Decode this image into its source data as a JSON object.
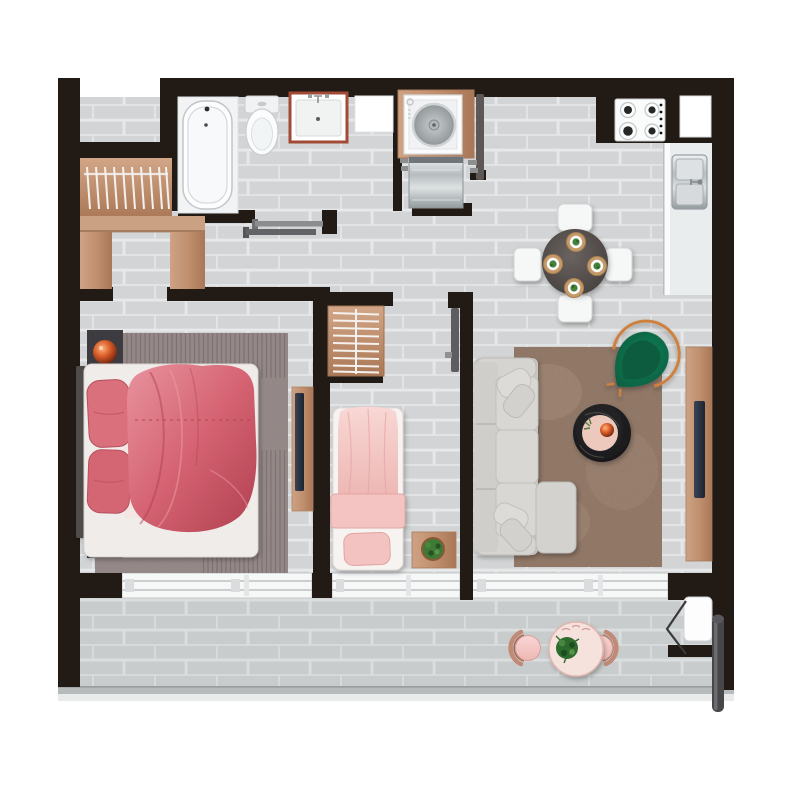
{
  "meta": {
    "description": "Top-down rendered apartment floor plan with two bedrooms, bathroom, laundry, open kitchen-dining, living room and full-width balcony",
    "canvas_width": 800,
    "canvas_height": 800,
    "background": "#ffffff"
  },
  "palette": {
    "walls": "#211a15",
    "floor_tile": "#d2d4d5",
    "tile_grout": "#e6e8e9",
    "balcony_tint": "#5a5d5e",
    "wood": "#c0906f",
    "bed_rose": "#cf5f6e",
    "bed_blush": "#f2c8c6",
    "sofa_gray": "#d3d2ce",
    "rug_brown": "#8d7260",
    "rug_mauve": "#998d8b",
    "armchair_green": "#0e6a47",
    "copper": "#c87f4f",
    "coffee_table": "#1c1c1e",
    "dining_table": "#534d4a",
    "steel": "#aeb4b7",
    "window_white": "#f6f7f7",
    "vanity_frame": "#a34a37"
  },
  "rooms": [
    {
      "name": "entry-walk-in-closet",
      "furniture": [
        "wardrobe with ten hangers",
        "wardrobe shelf",
        "two wood benches"
      ]
    },
    {
      "name": "bathroom",
      "furniture": [
        "bathtub",
        "toilet",
        "vanity sink with red-brown frame",
        "sliding door",
        "wall niche"
      ]
    },
    {
      "name": "laundry",
      "furniture": [
        "washing machine in wood counter",
        "stainless appliance",
        "open door leaf"
      ]
    },
    {
      "name": "kitchen-dining",
      "furniture": [
        "four-burner gas hob",
        "kitchen window",
        "counter with stainless sink",
        "round dining table",
        "four white chairs",
        "four place settings"
      ]
    },
    {
      "name": "master-bedroom",
      "furniture": [
        "double bed with rose duvet",
        "two rose pillows",
        "two charcoal nightstands",
        "two copper sphere lamps",
        "striped mauve rug",
        "wood tv sideboard",
        "tv"
      ]
    },
    {
      "name": "second-bedroom",
      "furniture": [
        "single bed with blush duvet",
        "closet with hanger rails",
        "wood side table",
        "potted plant",
        "door leaf"
      ]
    },
    {
      "name": "living-room",
      "furniture": [
        "gray corner sofa with chaise",
        "four scatter pillows",
        "brown shag rug",
        "round black marble coffee table",
        "pink tray with copper bowl",
        "green velvet armchair with copper frame",
        "wood tv sideboard",
        "tv"
      ]
    },
    {
      "name": "balcony",
      "furniture": [
        "round bistro table",
        "potted plant",
        "two blush chairs with copper backs",
        "balcony door swing",
        "downpipe",
        "railing"
      ]
    }
  ],
  "windows": [
    "master bedroom window two panes",
    "second bedroom window two panes",
    "living room window two panes",
    "kitchen window",
    "bathroom niche"
  ]
}
